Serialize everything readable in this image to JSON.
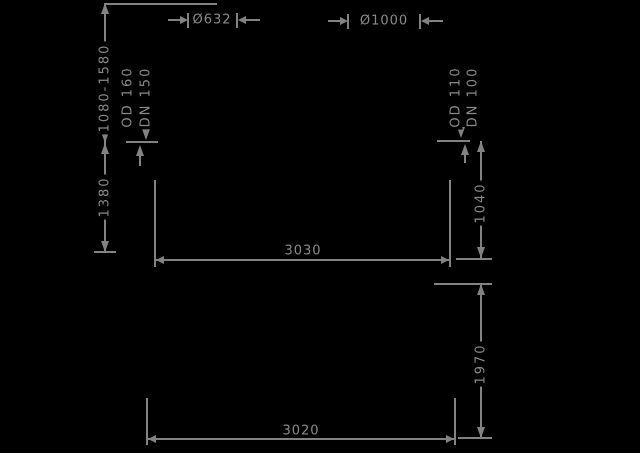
{
  "title": "tank-dimension-drawing",
  "colors": {
    "background": "#000000",
    "line": "#828282",
    "text": "#8a8a8a"
  },
  "upper_view": {
    "height_range": "1080-1580",
    "height_lower": "1380",
    "inlet_od": "OD 160",
    "inlet_dn": "DN 150",
    "outlet_od": "OD 110",
    "outlet_dn": "DN 100",
    "outlet_height": "1040",
    "overall_width": "3030",
    "left_diameter": "Ø632",
    "right_diameter": "Ø1000"
  },
  "lower_view": {
    "overall_height": "1970",
    "overall_width": "3020"
  }
}
